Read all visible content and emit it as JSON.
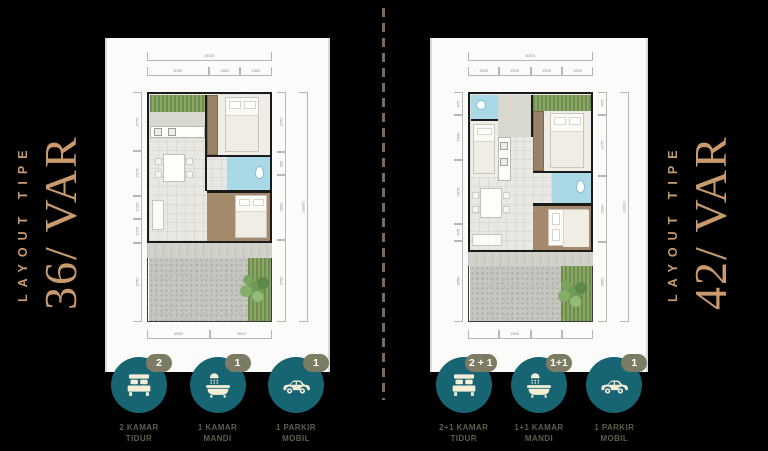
{
  "colors": {
    "background": "#000000",
    "accent_tan": "#c89a6e",
    "icon_teal": "#176473",
    "badge_olive": "#7c7b63",
    "label_olive": "#5f5e4b"
  },
  "panels": [
    {
      "title_kicker": "LAYOUT TIPE",
      "title_main": "36/ VAR",
      "dims": {
        "top_overall": "6000",
        "top_segments": [
          "3000",
          "1500",
          "1500"
        ],
        "left_segments": [
          "2775",
          "2075",
          "1025",
          "1075",
          "3750"
        ],
        "right_segments": [
          "2750",
          "950",
          "3000",
          "3750"
        ],
        "right_overall": "10000",
        "bottom_segments": [
          "3000",
          "3000"
        ]
      },
      "features": [
        {
          "icon": "bed-icon",
          "badge": "2",
          "label_line1": "2 KAMAR",
          "label_line2": "TIDUR"
        },
        {
          "icon": "bath-icon",
          "badge": "1",
          "label_line1": "1 KAMAR",
          "label_line2": "MANDI"
        },
        {
          "icon": "car-icon",
          "badge": "1",
          "label_line1": "1 PARKIR",
          "label_line2": "MOBIL"
        }
      ]
    },
    {
      "title_kicker": "LAYOUT TIPE",
      "title_main": "42/ VAR",
      "dims": {
        "top_overall": "6000",
        "top_segments": [
          "1500",
          "1500",
          "1500",
          "1500"
        ],
        "left_segments": [
          "975",
          "1950",
          "2875",
          "675",
          "3650"
        ],
        "right_segments": [
          "975",
          "2775",
          "3000",
          "3650"
        ],
        "right_overall": "10000",
        "bottom_segments": [
          "",
          "1500",
          "",
          ""
        ]
      },
      "features": [
        {
          "icon": "bed-icon",
          "badge": "2 + 1",
          "label_line1": "2+1 KAMAR",
          "label_line2": "TIDUR"
        },
        {
          "icon": "bath-icon",
          "badge": "1+1",
          "label_line1": "1+1 KAMAR",
          "label_line2": "MANDI"
        },
        {
          "icon": "car-icon",
          "badge": "1",
          "label_line1": "1 PARKIR",
          "label_line2": "MOBIL"
        }
      ]
    }
  ]
}
